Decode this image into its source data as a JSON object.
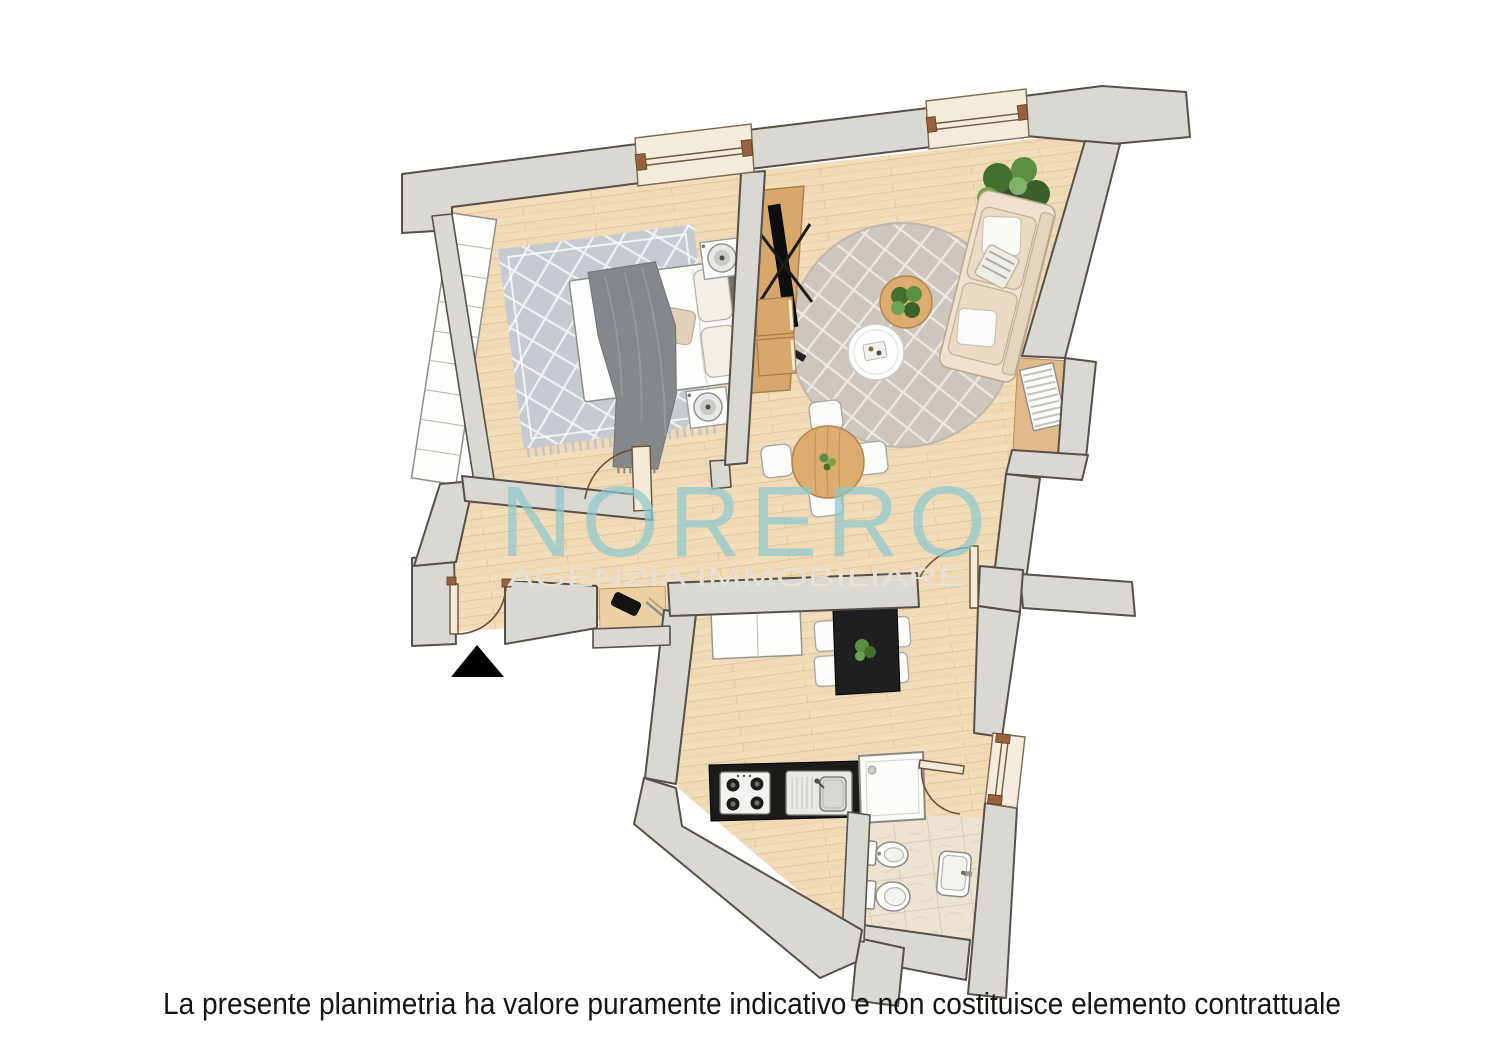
{
  "watermark": {
    "title": "NORERO",
    "subtitle": "AGENZIA IMMOBILIARE"
  },
  "footer": {
    "disclaimer": "La presente planimetria ha valore puramente indicativo e non costituisce elemento contrattuale"
  },
  "colors": {
    "wall_fill": "#d9d8d3",
    "wall_stroke": "#55504a",
    "wood_floor": "#f2ddba",
    "wood_plank_line": "#dcbf94",
    "bath_tile": "#ece3d0",
    "rug_gray": "#c6cbd2",
    "round_rug": "#cdc6be",
    "sofa_beige": "#efe1cb",
    "furniture_wood": "#dcab6e",
    "counter_black": "#1b1b19",
    "watermark_blue": "#8ec9cf",
    "watermark_gray": "#e6e3da",
    "plant_green": "#5b8f42",
    "entrance_marker": "#000000"
  },
  "floorplan": {
    "rooms": [
      {
        "id": "bedroom",
        "furniture": [
          "double-bed",
          "gray-throw-blanket",
          "pillows",
          "diamond-rug",
          "nightstand-with-lamp",
          "nightstand-with-lamp",
          "wardrobe-9-sections",
          "window"
        ]
      },
      {
        "id": "living-room",
        "furniture": [
          "sofa-with-cushions",
          "round-diamond-rug",
          "coffee-table-wood-with-plant",
          "coffee-table-white",
          "large-plant",
          "tv-wall-panel",
          "media-drawers",
          "round-dining-table",
          "chair",
          "chair",
          "chair",
          "chair",
          "radiator-niche",
          "window"
        ]
      },
      {
        "id": "hallway",
        "furniture": [
          "entrance-door",
          "shelf-niche-with-phone-and-pen",
          "bedroom-door"
        ]
      },
      {
        "id": "kitchen",
        "furniture": [
          "black-dining-table-with-plant",
          "chair",
          "chair",
          "chair",
          "chair",
          "white-cabinet",
          "counter-with-gas-hob",
          "counter-sink",
          "window"
        ]
      },
      {
        "id": "bathroom",
        "furniture": [
          "shower-box",
          "bidet",
          "toilet",
          "washbasin",
          "bathroom-door"
        ]
      }
    ],
    "entrance_marker": "black-triangle"
  }
}
